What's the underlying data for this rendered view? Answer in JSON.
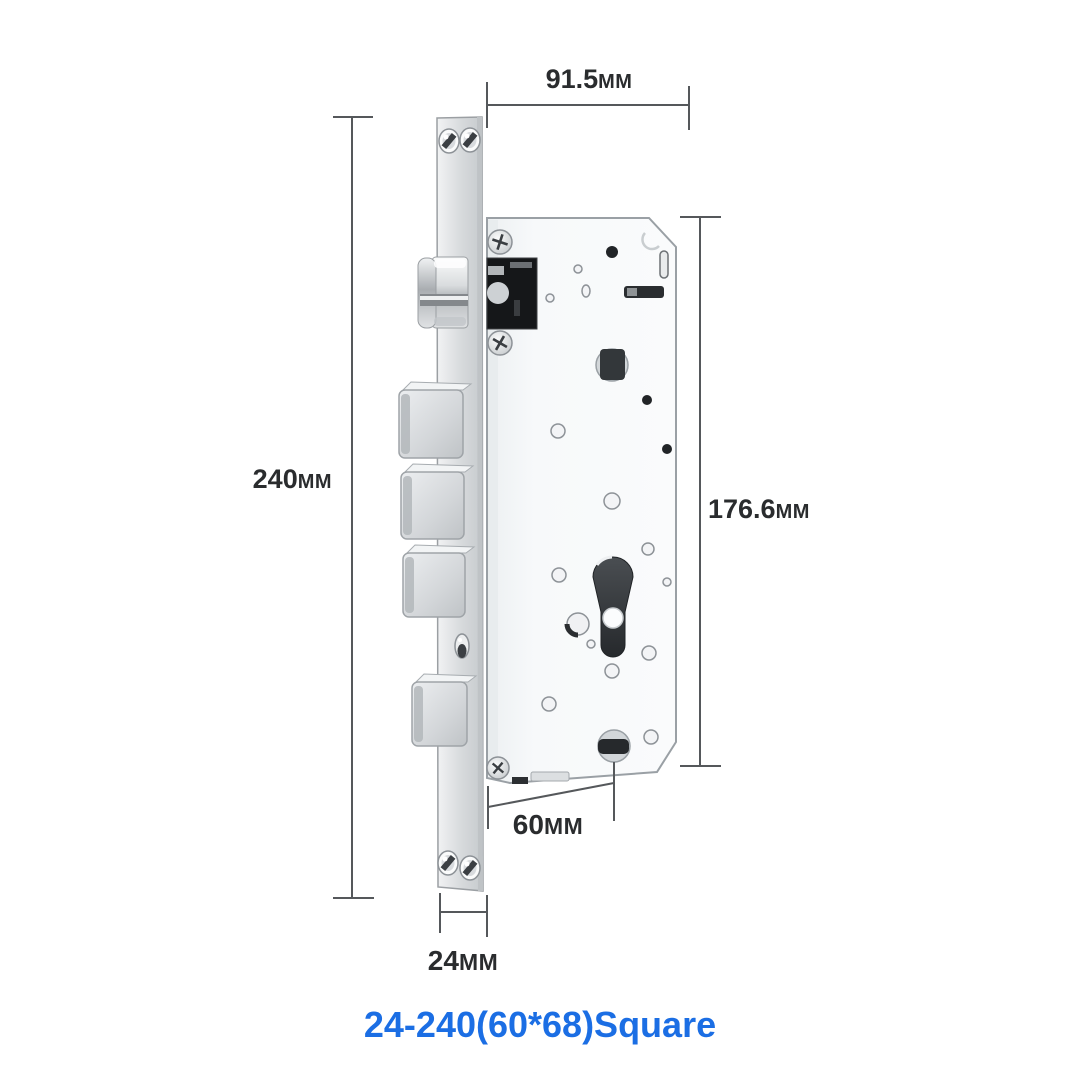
{
  "caption": {
    "label": "24-240(60*68)Square",
    "color": "#1b6ee4"
  },
  "dimensions": {
    "top_width": {
      "value": "91.5",
      "unit": "MM"
    },
    "overall_height": {
      "value": "240",
      "unit": "MM"
    },
    "case_height": {
      "value": "176.6",
      "unit": "MM"
    },
    "case_bottom_width": {
      "value": "60",
      "unit": "MM"
    },
    "faceplate_width": {
      "value": "24",
      "unit": "MM"
    }
  },
  "diagram": {
    "subject": "mortise-lock-body",
    "colors": {
      "background": "#ffffff",
      "dimension_line": "#55585b",
      "label_text": "#2a2c2e",
      "metal_light": "#f5f7f8",
      "metal_shadow": "#c2c6c9",
      "hole_dark": "#212427"
    }
  }
}
